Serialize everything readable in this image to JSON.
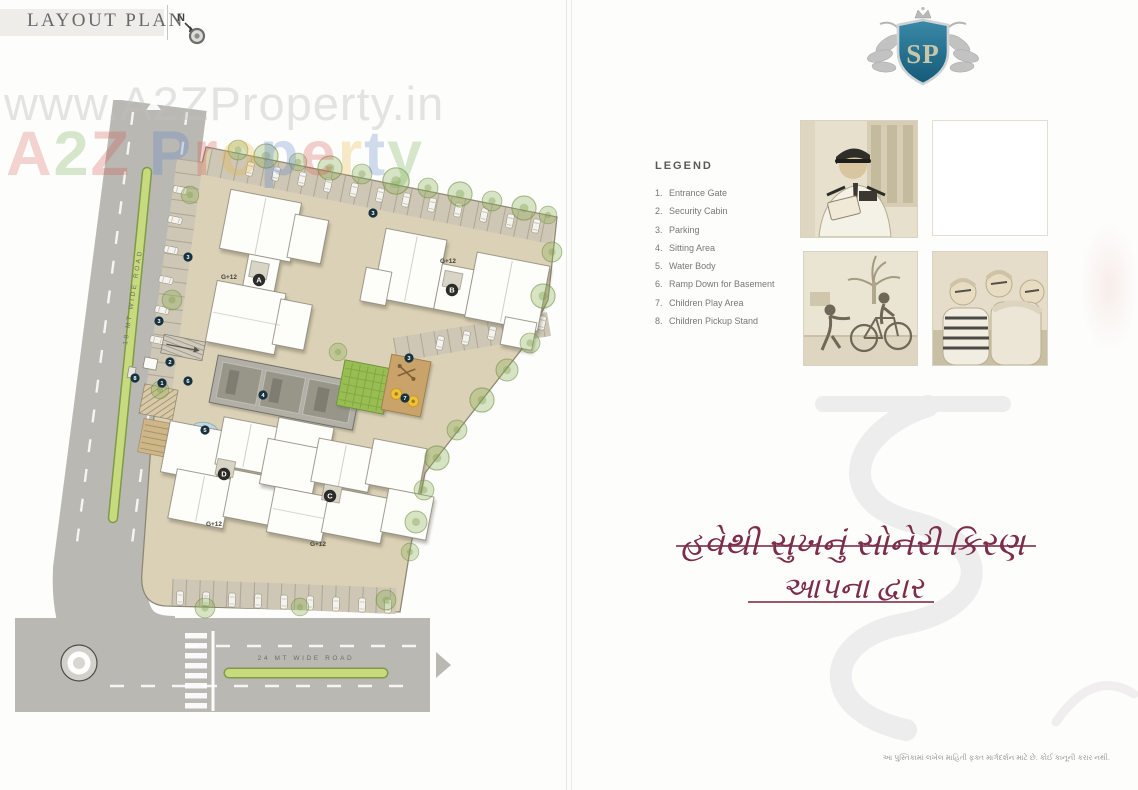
{
  "page": {
    "title": "LAYOUT PLAN",
    "north_label": "N"
  },
  "watermark": {
    "url_text": "www.A2ZProperty.in",
    "brand_letters": [
      {
        "ch": "A",
        "style": "color:#d96a5f"
      },
      {
        "ch": "2",
        "style": "color:#6fae4e"
      },
      {
        "ch": "Z",
        "style": "color:#d4574e"
      },
      {
        "ch": "P",
        "style": "color:#5b82c9"
      },
      {
        "ch": "r",
        "style": "color:#d4574e"
      },
      {
        "ch": "o",
        "style": "color:#e8b33c"
      },
      {
        "ch": "p",
        "style": "color:#5b82c9"
      },
      {
        "ch": "e",
        "style": "color:#d4574e"
      },
      {
        "ch": "r",
        "style": "color:#e8b33c"
      },
      {
        "ch": "t",
        "style": "color:#5b82c9"
      },
      {
        "ch": "y",
        "style": "color:#6fae4e"
      }
    ]
  },
  "plan": {
    "road_18": "18 MT WIDE ROAD",
    "road_24": "24 MT WIDE ROAD",
    "buildings": [
      {
        "id": "A",
        "floors": "G+12"
      },
      {
        "id": "B",
        "floors": "G+12"
      },
      {
        "id": "C",
        "floors": "G+12"
      },
      {
        "id": "D",
        "floors": "G+12"
      }
    ],
    "markers": {
      "m1": "1",
      "m2": "2",
      "m3": "3",
      "m4": "4",
      "m5": "5",
      "m6": "6",
      "m7": "7",
      "m8": "8"
    }
  },
  "legend": {
    "title": "LEGEND",
    "items": [
      {
        "num": "1.",
        "label": "Entrance Gate"
      },
      {
        "num": "2.",
        "label": "Security Cabin"
      },
      {
        "num": "3.",
        "label": "Parking"
      },
      {
        "num": "4.",
        "label": "Sitting Area"
      },
      {
        "num": "5.",
        "label": "Water Body"
      },
      {
        "num": "6.",
        "label": "Ramp Down for Basement"
      },
      {
        "num": "7.",
        "label": "Children Play Area"
      },
      {
        "num": "8.",
        "label": "Children Pickup Stand"
      }
    ]
  },
  "logo": {
    "initials": "SP",
    "shield_color": "#1f6a8c"
  },
  "tagline": {
    "line1": "હવેથી સુખનું સોનેરી કિરણ",
    "line2": "આપના દ્વાર",
    "color": "#7b2d4a"
  },
  "footer": {
    "disclaimer": "આ પુસ્તિકામાં લખેલ માહિતી ફક્ત માર્ગદર્શન માટે છે. કોઈ કાનૂની કરાર નથી."
  },
  "photos": [
    {
      "name": "security-guard"
    },
    {
      "name": "blank-frame"
    },
    {
      "name": "children-cycling"
    },
    {
      "name": "senior-citizens"
    }
  ]
}
